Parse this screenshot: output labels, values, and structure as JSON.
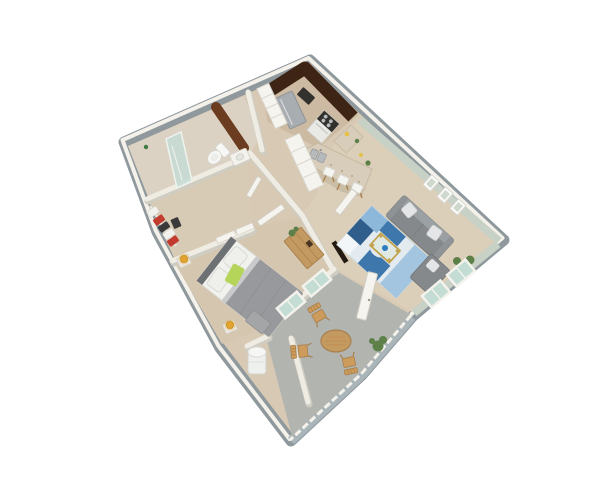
{
  "scene": {
    "title": "3D isometric floor plan render — one bedroom apartment",
    "view": "isometric-3d-cutaway",
    "background": "#ffffff"
  },
  "rooms": [
    {
      "name": "kitchen",
      "furniture": [
        "refrigerator",
        "range-cooktop",
        "microwave",
        "granite-breakfast-bar",
        "sink",
        "bar-stool",
        "bar-stool",
        "bar-stool",
        "pantry-shelving",
        "pantry-shelving",
        "counter-plant"
      ]
    },
    {
      "name": "living-room",
      "furniture": [
        "gray-sofa",
        "gray-chaise",
        "blue-area-rug",
        "gold-glass-coffee-table",
        "blue-bowl",
        "wall-frame",
        "wall-frame",
        "wall-frame",
        "potted-plant",
        "window",
        "window",
        "entry-door"
      ]
    },
    {
      "name": "bedroom",
      "furniture": [
        "double-bed",
        "headboard",
        "pillows",
        "green-throw",
        "nightstand",
        "nightstand",
        "amber-lamp",
        "amber-lamp",
        "wood-dresser",
        "dresser-plant",
        "foot-bench",
        "tv-panel",
        "bedroom-door",
        "window",
        "window"
      ]
    },
    {
      "name": "bathroom",
      "furniture": [
        "glass-shower",
        "toilet",
        "vanity-sink",
        "mirror-wall",
        "shelf-bottle",
        "bathroom-door"
      ]
    },
    {
      "name": "closet",
      "furniture": [
        "hanging-clothes",
        "suitcase",
        "sliding-door",
        "sliding-door"
      ]
    },
    {
      "name": "balcony",
      "furniture": [
        "round-wood-table",
        "wood-chair",
        "wood-chair",
        "wood-chair",
        "water-heater",
        "balcony-door",
        "potted-plant",
        "railing"
      ]
    }
  ],
  "counts": {
    "bar_stools": 3,
    "patio_chairs": 3,
    "wall_frames": 3,
    "amber_lamps": 2,
    "windows_living": 2,
    "windows_bedroom": 2
  },
  "colors": {
    "background": "#ffffff",
    "wall_top": "#f3f1ea",
    "wall_side": "#8f999d",
    "railing_side": "#aab5b9",
    "interior_wall": "#efece3",
    "interior_wall_shadow": "#cfccc2",
    "floor_main": "#d7c9b3",
    "floor_bedroom": "#d5c6b0",
    "floor_bath": "#dbd2c4",
    "floor_closet": "#d8cbb6",
    "floor_kitchen": "#cdbaa2",
    "floor_living": "#dccfba",
    "floor_balcony": "#b2b4b0",
    "cabinet_dark": "#3d2414",
    "vanity_brown": "#6b3c1f",
    "granite": "#d8cdbb",
    "granite_side": "#cabda6",
    "granite_speckle": "#a89878",
    "stainless": "#a7adb1",
    "appliance_dark": "#33312e",
    "sage_wall": "#c8d1c6",
    "sofa": "#85898c",
    "sofa_back": "#9ba0a3",
    "cushion": "#e4e5e6",
    "rug_base": "#e3ebf1",
    "rug_blue": "#3e77ab",
    "rug_blue_light": "#8db8da",
    "rug_blue_dark": "#2f5d8c",
    "gold": "#c2a34e",
    "bowl_blue": "#2e7cbe",
    "glass": "#c3dcd4",
    "bed_duvet": "#97999c",
    "headboard": "#6e7173",
    "linen": "#f1f1ee",
    "green_throw": "#b5d45a",
    "lamp_amber": "#e2a42f",
    "wood": "#c49a63",
    "wood_dark": "#a97f4b",
    "plant": "#5d8049",
    "toilet": "#f7f7f5",
    "clothes_red": "#c23b2e",
    "clothes_dark": "#3a3a3a",
    "heater_white": "#eef0ed",
    "door_white": "#f6f4ee",
    "tv_dark": "#241a12"
  }
}
